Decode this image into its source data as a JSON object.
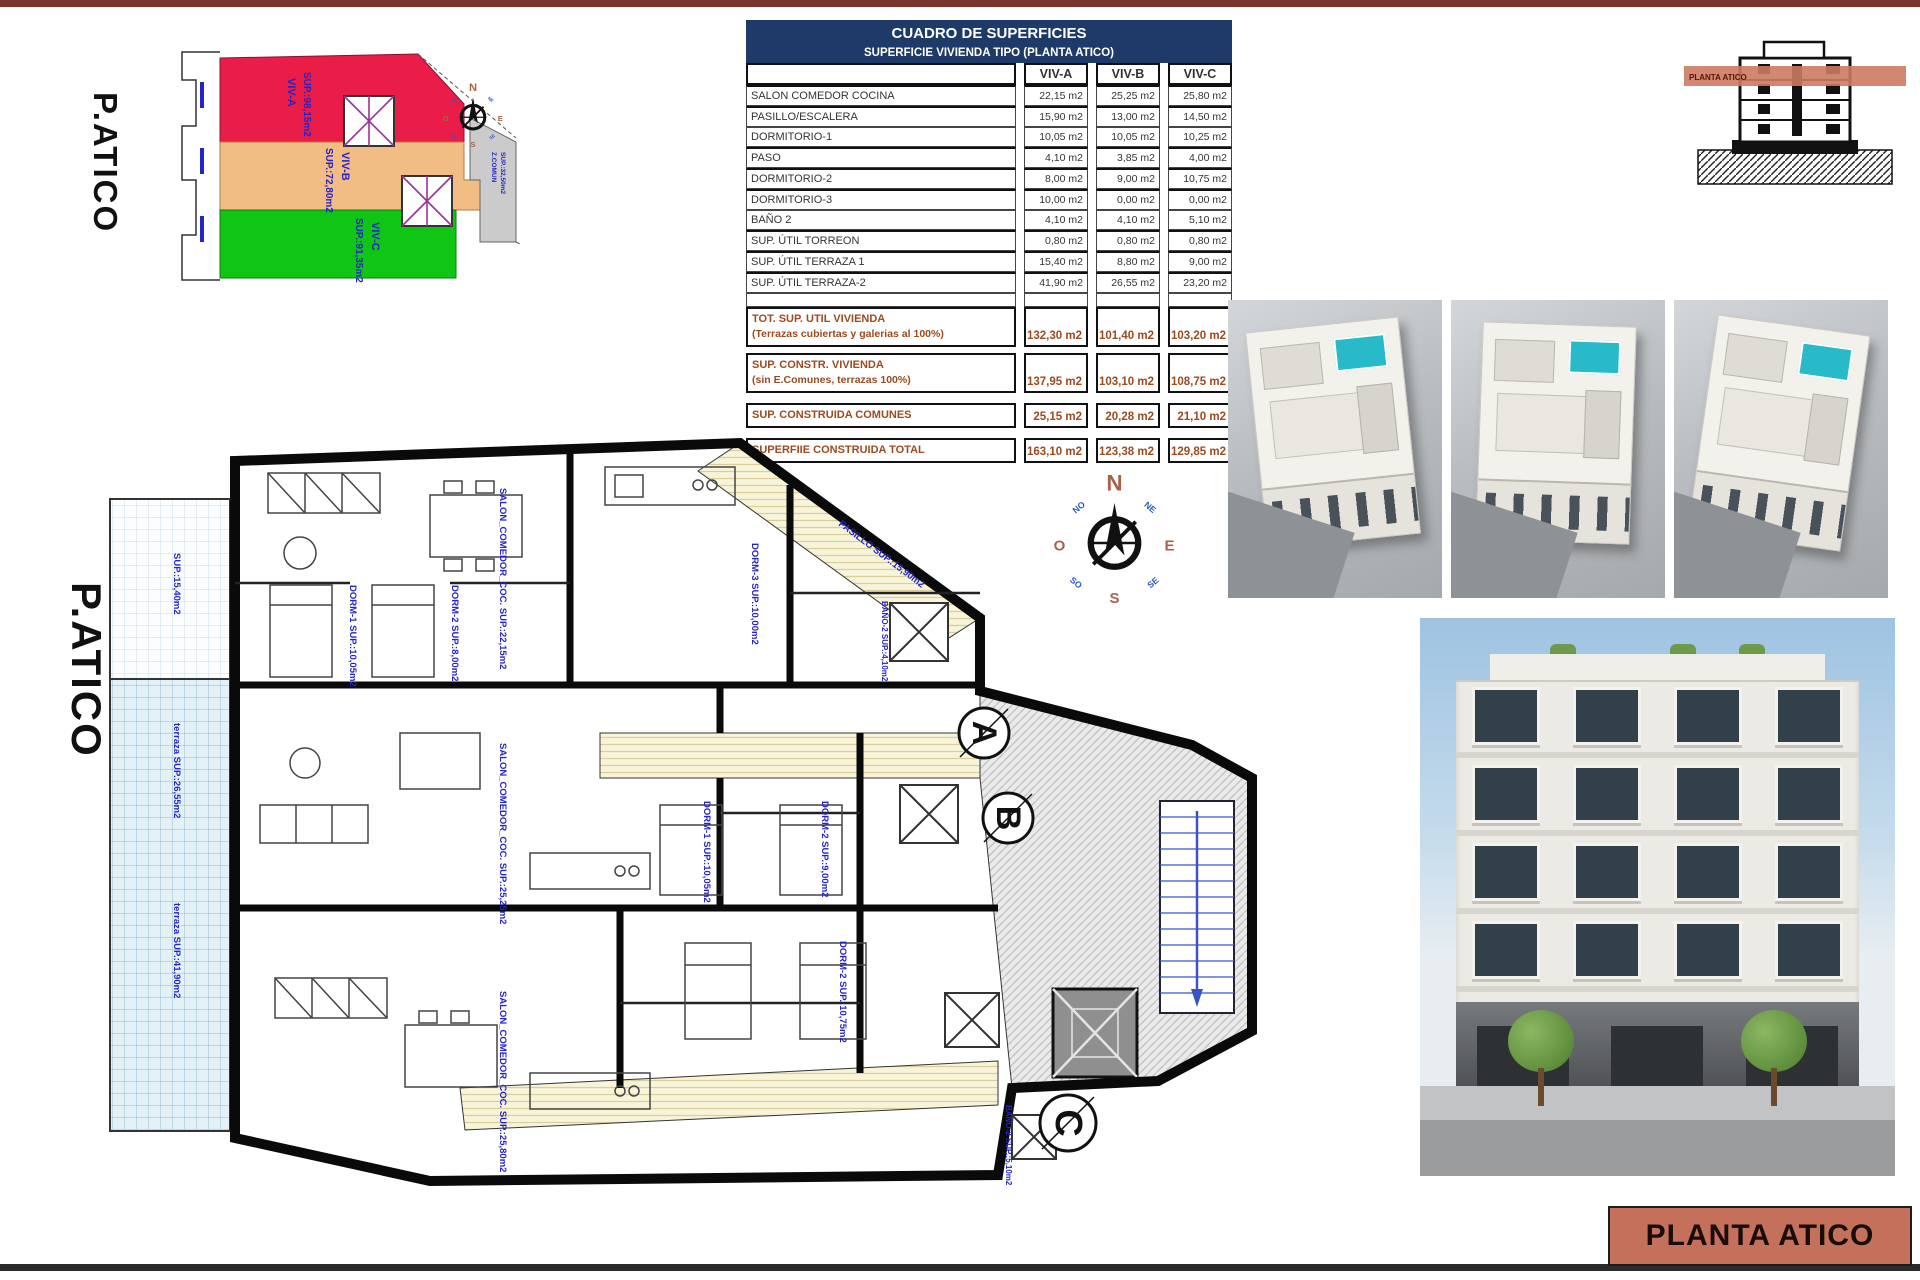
{
  "page": {
    "sheet_title": "PLANTA ATICO",
    "top_bar_color": "#7a332a",
    "bottom_bar_color": "#2b2b2b",
    "title_block_color": "#c4705a"
  },
  "site_diagram": {
    "title": "P.ATICO",
    "zones": [
      {
        "id": "viv-a",
        "label": "VIV-A",
        "sup": "SUP.:98,15m2",
        "color": "#ea1c48"
      },
      {
        "id": "viv-b",
        "label": "VIV-B",
        "sup": "SUP.:72,80m2",
        "color": "#f2bd85"
      },
      {
        "id": "viv-c",
        "label": "VIV-C",
        "sup": "SUP.:91,35m2",
        "color": "#10c513"
      },
      {
        "id": "z-comun",
        "label": "Z.COMUN",
        "sup": "SUP.:32,50m2",
        "color": "#cbcbcb"
      }
    ]
  },
  "compass": {
    "n": "N",
    "e": "E",
    "s": "S",
    "o": "O",
    "ne": "NE",
    "no": "NO",
    "se": "SE",
    "so": "SO"
  },
  "areas_table": {
    "title": "CUADRO DE SUPERFICIES",
    "subtitle": "SUPERFICIE VIVIENDA TIPO  (PLANTA ATICO)",
    "columns": [
      "VIV-A",
      "VIV-B",
      "VIV-C"
    ],
    "rows": [
      {
        "label": "SALON COMEDOR COCINA",
        "values": [
          "22,15 m2",
          "25,25 m2",
          "25,80 m2"
        ]
      },
      {
        "label": "PASILLO/ESCALERA",
        "values": [
          "15,90 m2",
          "13,00 m2",
          "14,50 m2"
        ]
      },
      {
        "label": "DORMITORIO-1",
        "values": [
          "10,05 m2",
          "10,05 m2",
          "10,25 m2"
        ]
      },
      {
        "label": "PASO",
        "values": [
          "4,10 m2",
          "3,85 m2",
          "4,00 m2"
        ]
      },
      {
        "label": "DORMITORIO-2",
        "values": [
          "8,00 m2",
          "9,00 m2",
          "10,75 m2"
        ]
      },
      {
        "label": "DORMITORIO-3",
        "values": [
          "10,00 m2",
          "0,00 m2",
          "0,00 m2"
        ]
      },
      {
        "label": "BAÑO 2",
        "values": [
          "4,10 m2",
          "4,10 m2",
          "5,10 m2"
        ]
      },
      {
        "label": "SUP. ÚTIL TORREON",
        "values": [
          "0,80 m2",
          "0,80 m2",
          "0,80 m2"
        ]
      },
      {
        "label": "SUP. ÚTIL TERRAZA 1",
        "values": [
          "15,40 m2",
          "8,80 m2",
          "9,00 m2"
        ]
      },
      {
        "label": "SUP. ÚTIL TERRAZA-2",
        "values": [
          "41,90 m2",
          "26,55 m2",
          "23,20 m2"
        ]
      }
    ],
    "summary_rows": [
      {
        "label": "TOT. SUP. UTIL VIVIENDA",
        "sublabel": "(Terrazas cubiertas y galerias al 100%)",
        "values": [
          "132,30 m2",
          "101,40 m2",
          "103,20 m2"
        ]
      },
      {
        "label": "SUP. CONSTR. VIVIENDA",
        "sublabel": "(sin E.Comunes, terrazas 100%)",
        "values": [
          "137,95 m2",
          "103,10 m2",
          "108,75 m2"
        ]
      },
      {
        "label": "SUP. CONSTRUIDA COMUNES",
        "sublabel": "",
        "values": [
          "25,15 m2",
          "20,28 m2",
          "21,10 m2"
        ]
      },
      {
        "label": "SUPERFIIE CONSTRUIDA TOTAL",
        "sublabel": "",
        "values": [
          "163,10 m2",
          "123,38 m2",
          "129,85 m2"
        ]
      }
    ]
  },
  "floor_plan": {
    "title": "P.ATICO",
    "unit_markers": [
      "A",
      "B",
      "C"
    ],
    "labels": [
      "SALON_COMEDOR_COC. SUP.:22,15m2",
      "DORM-1 SUP.:10,05m2",
      "DORM-3 SUP.:10,00m2",
      "BAÑO-2 SUP.:4,10m2",
      "PASILLO SUP.:15,90m2",
      "SALON_COMEDOR_COC. SUP.:25,25m2",
      "DORM-1 SUP.:10,05m2",
      "DORM-2 SUP.:9,00m2",
      "SALON_COMEDOR_COC. SUP.:25,80m2",
      "DORM-2 SUP.:10,75m2",
      "BAÑO-2 SUP.:5,10m2",
      "terraza SUP.:41,90m2",
      "terraza SUP.:26,55m2",
      "SUP.:15,40m2",
      "DORM-2 SUP.:8,00m2"
    ]
  },
  "section_thumb": {
    "band_label": "PLANTA ATICO"
  }
}
